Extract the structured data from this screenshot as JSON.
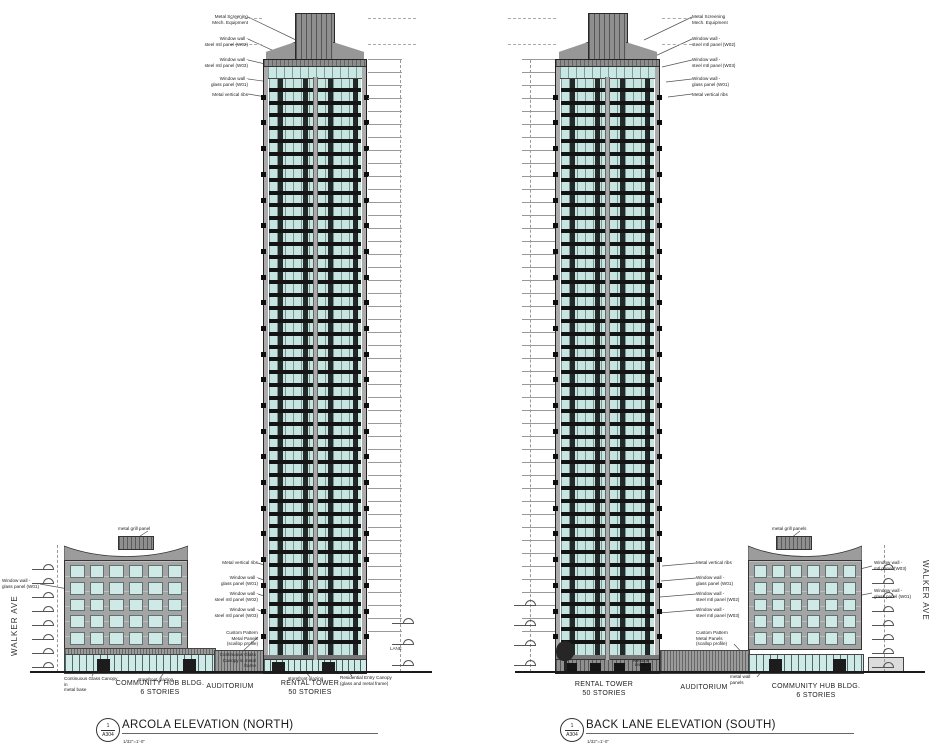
{
  "colors": {
    "glazing": "#c9e7e3",
    "spandrel": "#141414",
    "wall_gray": "#9c9c9c",
    "line": "#222222"
  },
  "tower": {
    "floors_rendered": 44
  },
  "north": {
    "title": "ARCOLA ELEVATION (NORTH)",
    "detail_no": "1",
    "sheet": "A304",
    "scale": "1/32\"=1'-0\"",
    "street": "WALKER AVE",
    "lane": "LANE",
    "labels": {
      "hub": "COMMUNITY HUB BLDG.\n6 STORIES",
      "auditorium": "AUDITORIUM",
      "tower": "RENTAL TOWER\n50 STORIES"
    },
    "callouts_top": [
      {
        "text": "Metal Screening\nMech. Equipment"
      },
      {
        "text": "Window wall -\nsteel mtl panel (W02)"
      },
      {
        "text": "Window wall -\nsteel mtl panel (W03)"
      },
      {
        "text": "Window wall -\nglass panel (W01)"
      },
      {
        "text": "Metal vertical ribs"
      }
    ],
    "callouts_mid": [
      {
        "text": "Metal vertical ribs"
      },
      {
        "text": "Window wall -\nglass panel (W01)"
      },
      {
        "text": "Window wall -\nsteel mtl panel (W02)"
      },
      {
        "text": "Window wall -\nsteel mtl panel (W03)"
      },
      {
        "text": "Custom Pattern\nMetal Panels\n(scallop profile)"
      },
      {
        "text": "Continuous Glass\nCanopy in metal\nframe"
      }
    ],
    "callouts_base": [
      {
        "text": "Continuous Glass Canopy in\nmetal base"
      },
      {
        "text": "storefront glazing"
      },
      {
        "text": "storefront glazing"
      },
      {
        "text": "Residential Entry Canopy\n(glass and metal frame)"
      }
    ],
    "callout_hub_top": "metal grill panel",
    "callout_hub_side": "Window wall -\nglass panel (W01)"
  },
  "south": {
    "title": "BACK LANE ELEVATION (SOUTH)",
    "detail_no": "1",
    "sheet": "A304",
    "scale": "1/32\"=1'-0\"",
    "street": "WALKER AVE",
    "labels": {
      "tower": "RENTAL TOWER\n50 STORIES",
      "auditorium": "AUDITORIUM",
      "hub": "COMMUNITY  HUB BLDG.\n6 STORIES"
    },
    "callouts_top": [
      {
        "text": "Metal Screening\nMech. Equipment"
      },
      {
        "text": "Window wall -\nsteel mtl panel (W02)"
      },
      {
        "text": "Window wall -\nsteel mtl panel (W03)"
      },
      {
        "text": "Window wall -\nglass panel (W01)"
      },
      {
        "text": "Metal vertical ribs"
      }
    ],
    "callouts_mid": [
      {
        "text": "Metal vertical ribs"
      },
      {
        "text": "Window wall -\nglass panel (W01)"
      },
      {
        "text": "Window wall -\nsteel mtl panel (W02)"
      },
      {
        "text": "Window wall -\nsteel mtl panel (W03)"
      },
      {
        "text": "Custom Pattern\nMetal Panels\n(scallop profile)"
      }
    ],
    "callouts_base": [
      {
        "text": "metal wall\npanels"
      }
    ],
    "callouts_hub_side": [
      {
        "text": "Window wall -\nmtl panel (W03)"
      },
      {
        "text": "Window wall -\nglass panel (W01)"
      }
    ],
    "callout_hub_top": "metal grill panels",
    "parkade": "PARKADE\nENTRY"
  }
}
